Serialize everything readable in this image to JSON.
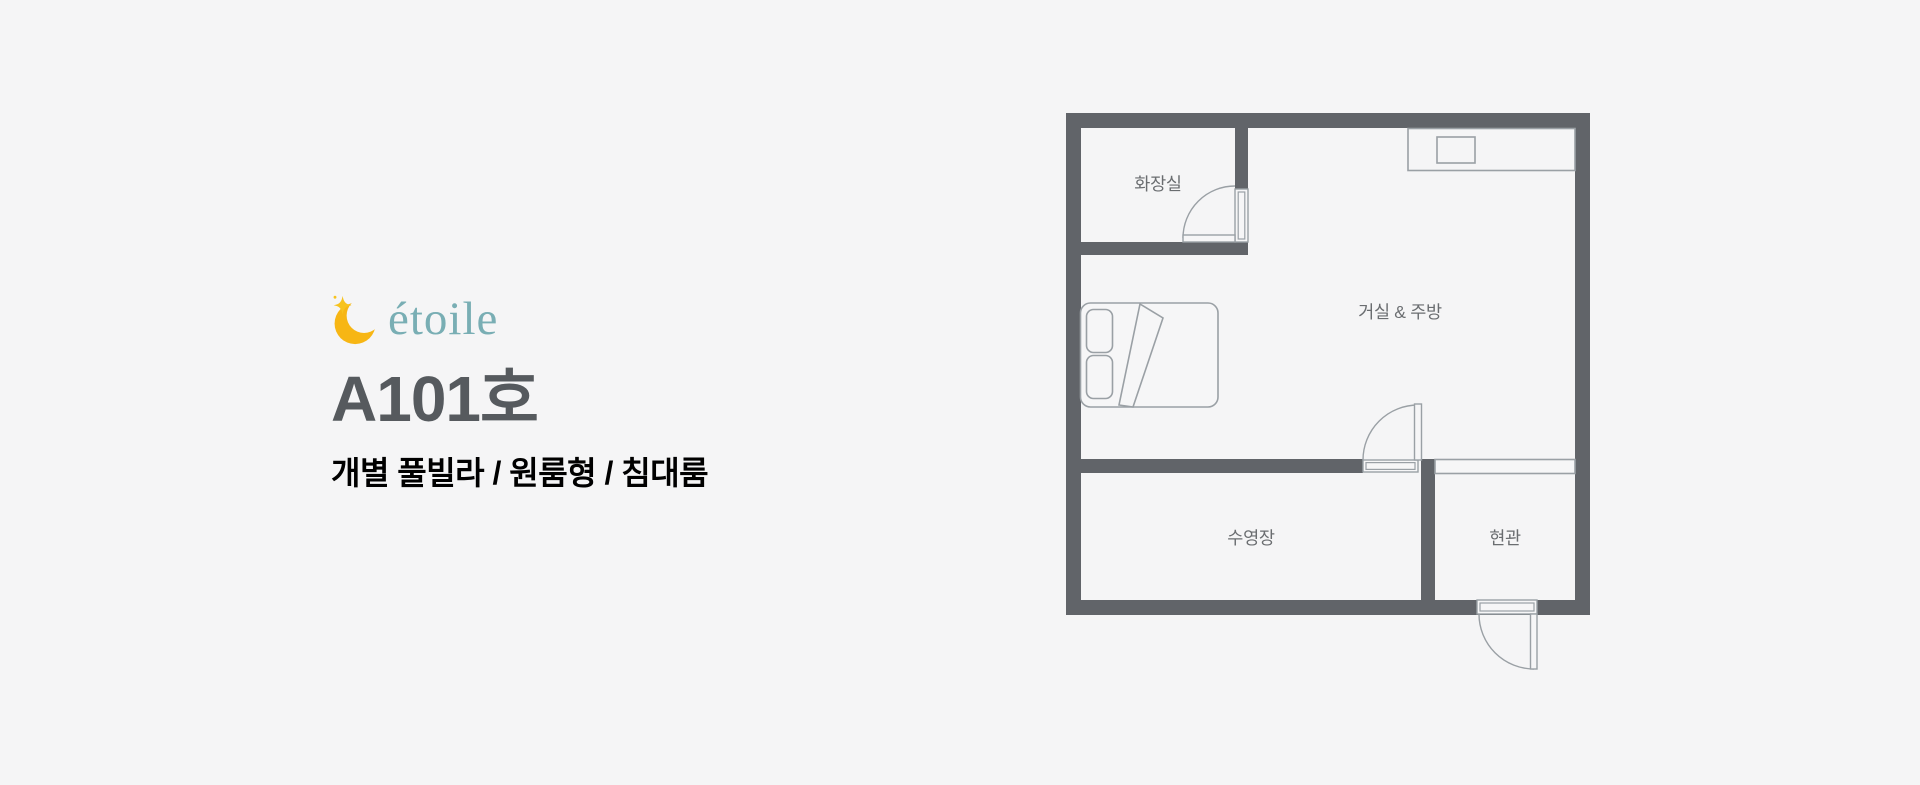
{
  "page": {
    "background_color": "#f5f5f6"
  },
  "brand": {
    "logo_text": "étoile",
    "logo_text_color": "#79aeb4",
    "moon_color": "#f7b614",
    "sparkle_color": "#f7c31e",
    "room_title": "A101호",
    "room_title_color": "#565a5e",
    "room_subtitle": "개별 풀빌라 / 원룸형 / 침대룸",
    "room_subtitle_color": "#505457"
  },
  "floorplan": {
    "wall_color": "#616469",
    "line_color": "#9aa0a5",
    "label_color": "#6a6d70",
    "interior_color": "#f6f6f7",
    "rooms": [
      {
        "id": "bathroom",
        "label": "화장실"
      },
      {
        "id": "living-kitchen",
        "label": "거실 & 주방"
      },
      {
        "id": "pool",
        "label": "수영장"
      },
      {
        "id": "entrance",
        "label": "현관"
      }
    ]
  }
}
